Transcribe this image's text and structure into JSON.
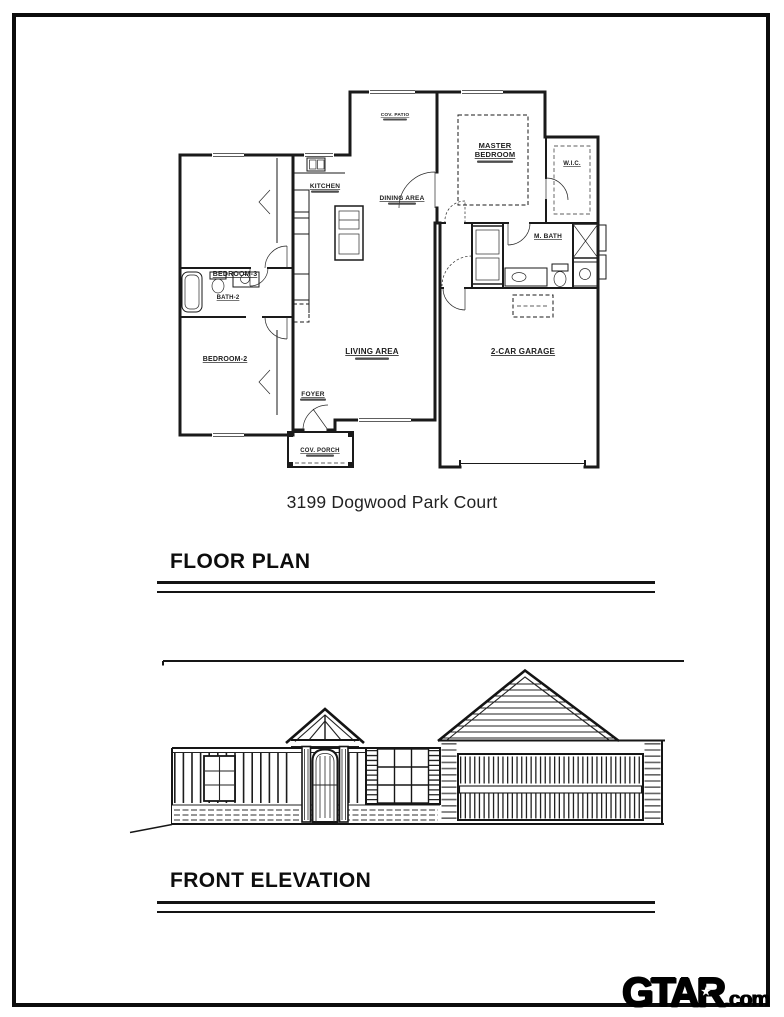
{
  "page": {
    "address_title": "3199 Dogwood Park Court"
  },
  "sections": {
    "floor_plan": {
      "title": "FLOOR PLAN"
    },
    "front_elevation": {
      "title": "FRONT ELEVATION"
    }
  },
  "floor_plan": {
    "labels": {
      "bedroom3": "BEDROOM-3",
      "kitchen": "KITCHEN",
      "dining_area": "DINING AREA",
      "master_line1": "MASTER",
      "master_line2": "BEDROOM",
      "wic": "W.I.C.",
      "mbath": "M. BATH",
      "bath2": "BATH-2",
      "bedroom2": "BEDROOM-2",
      "living_area": "LIVING AREA",
      "garage": "2-CAR GARAGE",
      "foyer": "FOYER",
      "cov_porch": "COV. PORCH",
      "cov_patio": "COV. PATIO"
    }
  },
  "watermark": {
    "brand": "GTAR",
    "star": "★",
    "tld": ".com"
  },
  "colors": {
    "ink": "#111111",
    "frame": "#0c0c0c"
  }
}
